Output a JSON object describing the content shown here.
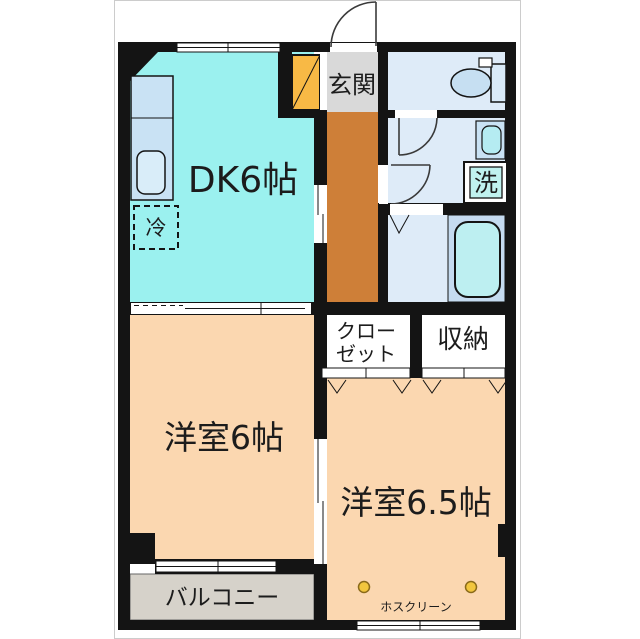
{
  "plan_title": "1DK-2room-floor-plan",
  "rooms": {
    "dk": "DK6帖",
    "genkan": "玄関",
    "west6": "洋室6帖",
    "west65": "洋室6.5帖",
    "closet_line1": "クロー",
    "closet_line2": "ゼット",
    "storage": "収納",
    "balcony": "バルコニー",
    "hosclean": "ホスクリーン",
    "fridge": "冷",
    "washer": "洗"
  },
  "colors": {
    "wall": "#141414",
    "dk": "#9BF1EF",
    "room": "#FBD7B0",
    "corridor": "#CE7F38",
    "shoebox": "#F8B945",
    "genkan": "#D9D9D9",
    "water_floor": "#DEEBF8",
    "bath_panel": "#C5DBF0",
    "tub": "#BDEFF1",
    "kitchen_unit": "#C9E2F4",
    "kitchen_sink": "#D9EDF9",
    "basin": "#B5ECF2",
    "washer_fill": "#C0F2EF",
    "balcony_floor": "#D6D2CA",
    "hook": "#F2C63E",
    "toilet_tank": "#D9EAF8",
    "toilet_bowl": "#C6DFF2"
  }
}
